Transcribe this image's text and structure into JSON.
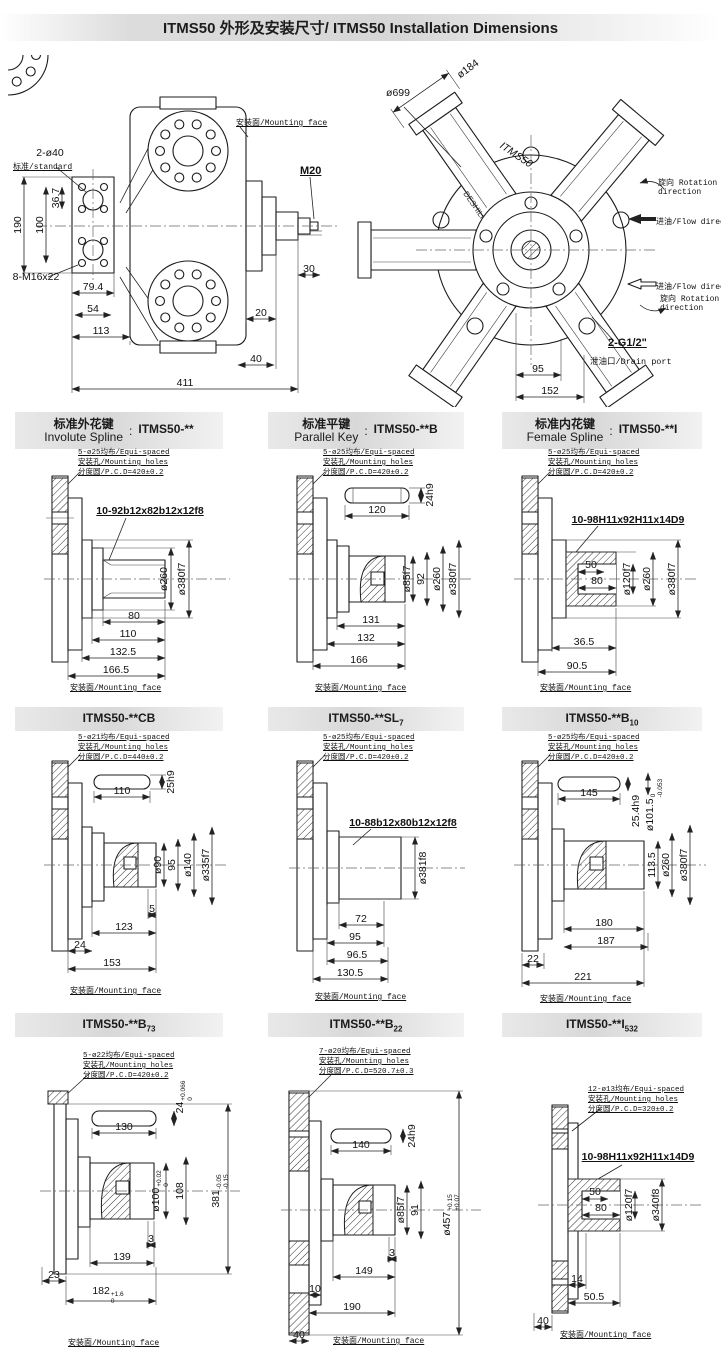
{
  "title": "ITMS50 外形及安装尺寸/ ITMS50 Installation Dimensions",
  "side_view": {
    "mounting_face": "安装面/Mounting face",
    "holes": "2-ø40",
    "standard": "标准/standard",
    "bolts": "8-M16x22",
    "thread": "M20",
    "d190": "190",
    "d100": "100",
    "d36_7": "36.7",
    "d79_4": "79.4",
    "d54": "54",
    "d113": "113",
    "d411": "411",
    "d30": "30",
    "d20": "20",
    "d40": "40"
  },
  "front_view": {
    "model": "ITMS50",
    "brand": "DESHILI",
    "d699": "ø699",
    "d184": "ø184",
    "rot_cn": "旋向",
    "rot_en": "Rotation direction",
    "flow": "进油/Flow direction",
    "drain_size": "2-G1/2\"",
    "drain": "泄油口/Drain port",
    "d95": "95",
    "d152": "152"
  },
  "sections": [
    {
      "cn": "标准外花键",
      "en": "Involute Spline",
      "sep": ":",
      "model": "ITMS50-**",
      "sub": "",
      "ann": [
        "5-ø25均布/Equi-spaced",
        "安装孔/Mounting holes",
        "分度圆/P.C.D=420±0.2"
      ],
      "spline": "10-92b12x82b12x12f8",
      "dia": [
        "ø260",
        "ø380f7"
      ],
      "dims": [
        "80",
        "110",
        "132.5",
        "166.5"
      ],
      "mf": "安装面/Mounting face"
    },
    {
      "cn": "标准平键",
      "en": "Parallel Key",
      "sep": ":",
      "model": "ITMS50-**B",
      "sub": "",
      "ann": [
        "5-ø25均布/Equi-spaced",
        "安装孔/Mounting holes",
        "分度圆/P.C.D=420±0.2"
      ],
      "key_len": "120",
      "key_w": "24h9",
      "dia": [
        "ø85f7",
        "92",
        "ø260",
        "ø380f7"
      ],
      "dims": [
        "131",
        "132",
        "166"
      ],
      "mf": "安装面/Mounting face"
    },
    {
      "cn": "标准内花键",
      "en": "Female Spline",
      "sep": ":",
      "model": "ITMS50-**I",
      "sub": "",
      "ann": [
        "5-ø25均布/Equi-spaced",
        "安装孔/Mounting holes",
        "分度圆/P.C.D=420±0.2"
      ],
      "spline": "10-98H11x92H11x14D9",
      "bore": [
        "50",
        "80"
      ],
      "dia": [
        "ø120f7",
        "ø260",
        "ø380f7"
      ],
      "dims": [
        "36.5",
        "90.5"
      ],
      "mf": "安装面/Mounting face"
    },
    {
      "model": "ITMS50-**CB",
      "sub": "",
      "ann": [
        "5-ø21均布/Equi-spaced",
        "安装孔/Mounting holes",
        "分度圆/P.C.D=440±0.2"
      ],
      "key_len": "110",
      "key_w": "25h9",
      "dia": [
        "ø90",
        "95",
        "ø140",
        "ø335f7"
      ],
      "dims": [
        "5",
        "123",
        "24",
        "153"
      ],
      "mf": "安装面/Mounting face"
    },
    {
      "model": "ITMS50-**SL",
      "sub": "7",
      "ann": [
        "5-ø25均布/Equi-spaced",
        "安装孔/Mounting holes",
        "分度圆/P.C.D=420±0.2"
      ],
      "spline": "10-88b12x80b12x12f8",
      "dia": [
        "ø381f8"
      ],
      "dims": [
        "72",
        "95",
        "96.5",
        "130.5"
      ],
      "mf": "安装面/Mounting face"
    },
    {
      "model": "ITMS50-**B",
      "sub": "10",
      "ann": [
        "5-ø25均布/Equi-spaced",
        "安装孔/Mounting holes",
        "分度圆/P.C.D=420±0.2"
      ],
      "key_len": "145",
      "key_w": "25.4h9",
      "dia_tol": {
        "v": "ø101.5",
        "up": "0",
        "dn": "-0.053"
      },
      "dia": [
        "113.5",
        "ø260",
        "ø380f7"
      ],
      "dims": [
        "180",
        "187",
        "22",
        "221"
      ],
      "mf": "安装面/Mounting face"
    },
    {
      "model": "ITMS50-**B",
      "sub": "73",
      "ann": [
        "5-ø22均布/Equi-spaced",
        "安装孔/Mounting holes",
        "分度圆/P.C.D=420±0.2"
      ],
      "key_len": "130",
      "key_w_tol": {
        "v": "24",
        "up": "+0.066",
        "dn": "0"
      },
      "dia_tol": {
        "v": "ø100",
        "up": "+0.02",
        "dn": "0"
      },
      "dia": [
        "108"
      ],
      "len_tol": {
        "v": "381",
        "up": "-0.05",
        "dn": "-0.15"
      },
      "dims": [
        "3",
        "139",
        "23"
      ],
      "dim_tol": {
        "v": "182",
        "up": "+1.6",
        "dn": "0"
      },
      "mf": "安装面/Mounting face"
    },
    {
      "model": "ITMS50-**B",
      "sub": "22",
      "ann": [
        "7-ø20均布/Equi-spaced",
        "安装孔/Mounting holes",
        "分度圆/P.C.D=520.7±0.3"
      ],
      "key_len": "140",
      "key_w": "24h9",
      "dia": [
        "ø85f7",
        "91"
      ],
      "dia_tol": {
        "v": "ø457",
        "up": "+0.15",
        "dn": "+0.07"
      },
      "dims": [
        "3",
        "149",
        "10",
        "190",
        "40"
      ],
      "mf": "安装面/Mounting face"
    },
    {
      "model": "ITMS50-**I",
      "sub": "532",
      "ann": [
        "12-ø13均布/Equi-spaced",
        "安装孔/Mounting holes",
        "分度圆/P.C.D=320±0.2"
      ],
      "spline": "10-98H11x92H11x14D9",
      "bore": [
        "50",
        "80"
      ],
      "dia": [
        "ø120f7",
        "ø340f8"
      ],
      "dims": [
        "14",
        "50.5",
        "40"
      ],
      "mf": "安装面/Mounting face"
    }
  ]
}
